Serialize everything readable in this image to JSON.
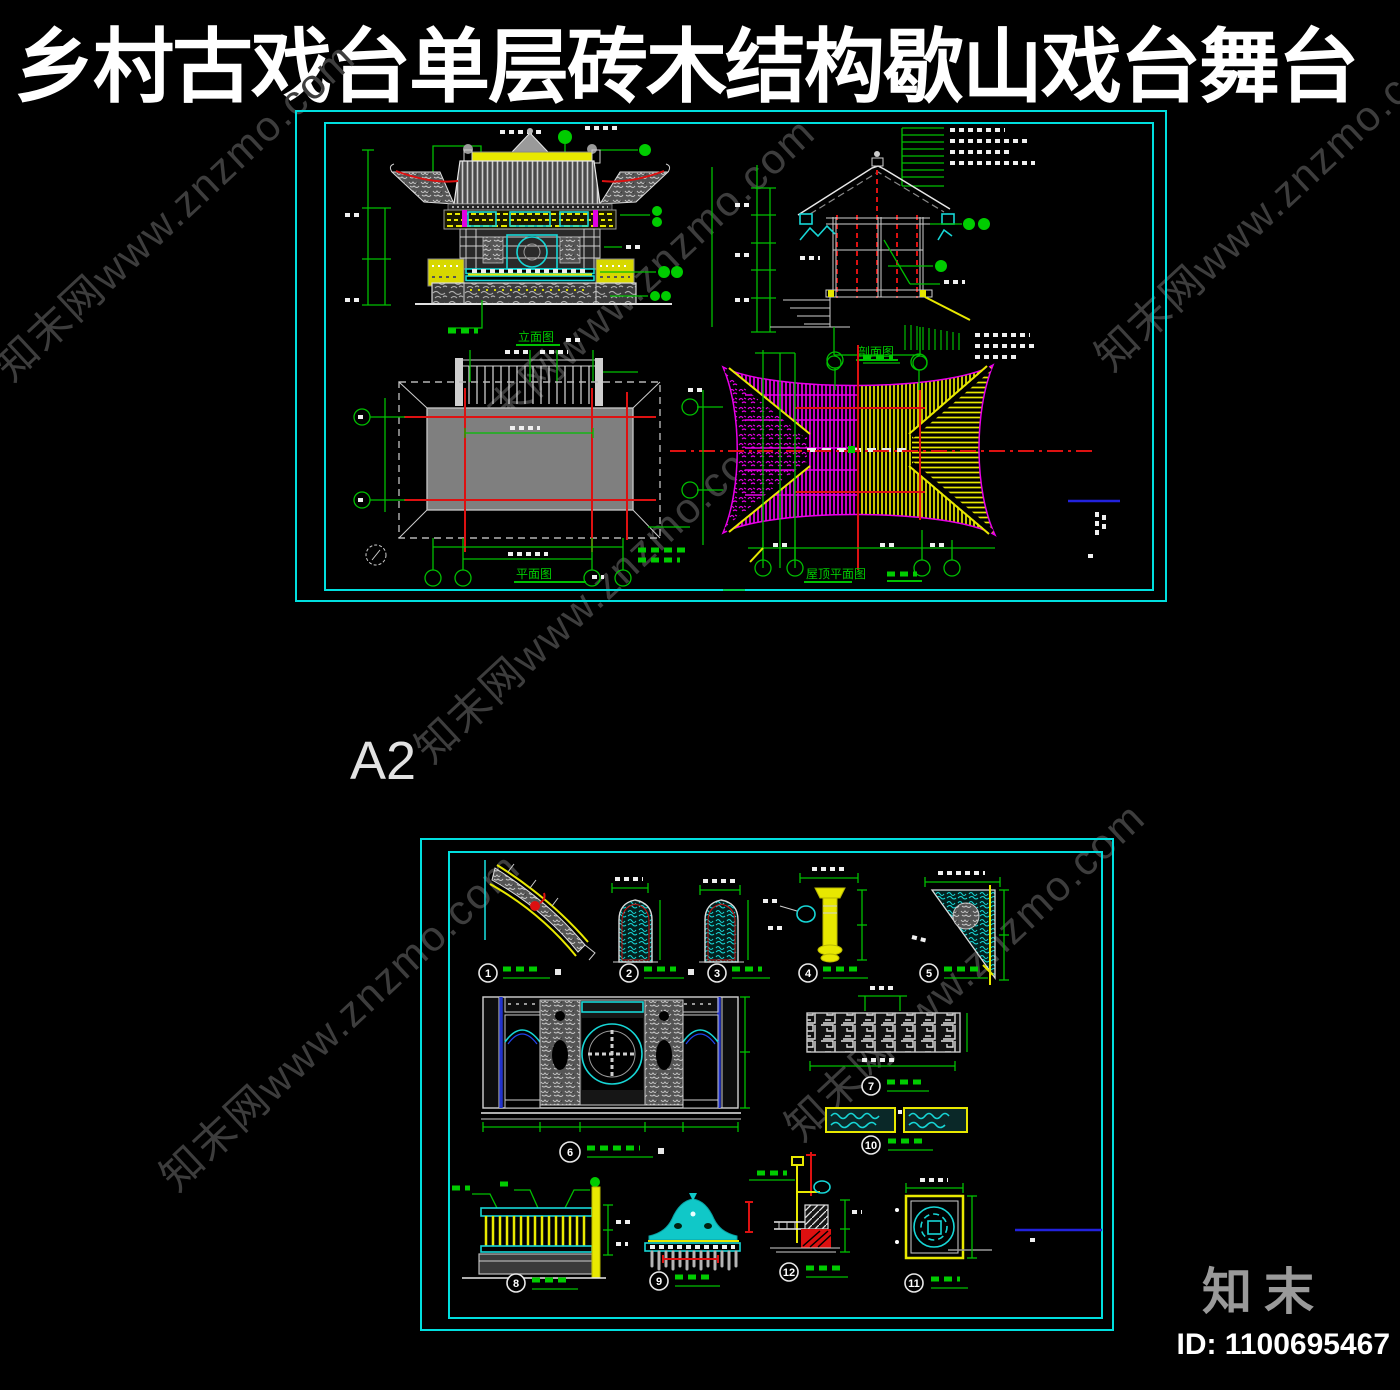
{
  "title": "乡村古戏台单层砖木结构歇山戏台舞台",
  "sheet_label": "A2",
  "watermark": {
    "text": "知末网www.znzmo.com"
  },
  "footer": {
    "brand": "知末",
    "id_label": "ID: 1100695467"
  },
  "colors": {
    "background": "#000000",
    "sheet_border": "#00dfdf",
    "dimension_green": "#00bf00",
    "centerline_red": "#dd1111",
    "roof_left_magenta": "#e800e8",
    "roof_right_yellow": "#e8e800",
    "detail_cyan": "#17d6d6",
    "blue_line": "#2222dd",
    "white_line": "#e8e8e8"
  },
  "sheet1": {
    "views": {
      "elevation_label": "立面图",
      "section_label": "剖面图",
      "plan_label": "平面图",
      "roof_plan_label": "屋顶平面图"
    }
  },
  "sheet2": {
    "details": [
      {
        "no": "1"
      },
      {
        "no": "2"
      },
      {
        "no": "3"
      },
      {
        "no": "4"
      },
      {
        "no": "5"
      },
      {
        "no": "6"
      },
      {
        "no": "7"
      },
      {
        "no": "8"
      },
      {
        "no": "9"
      },
      {
        "no": "10"
      },
      {
        "no": "11"
      },
      {
        "no": "12"
      }
    ]
  }
}
